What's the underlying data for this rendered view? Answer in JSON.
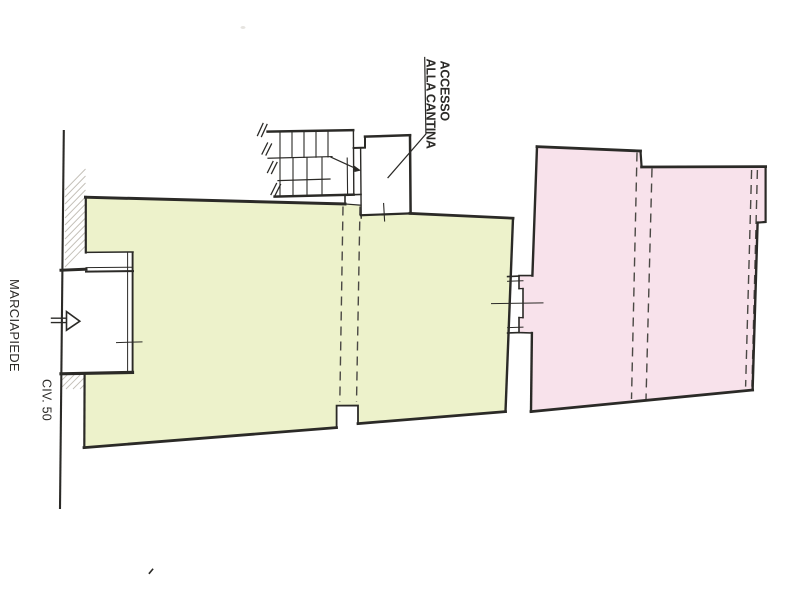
{
  "drawing": {
    "labels": {
      "sidewalk": "MARCIAPIEDE",
      "civic_number": "CIV. 50",
      "cellar_access_line1": "ACCESSO",
      "cellar_access_line2": "ALLA CANTINA"
    },
    "colors": {
      "left_unit_fill": "#edf2cb",
      "right_unit_fill": "#f8e2eb",
      "ink": "#2b2a27",
      "ink_soft": "#4a4844",
      "hatch": "#c3bfb7",
      "paper": "#ffffff"
    }
  }
}
